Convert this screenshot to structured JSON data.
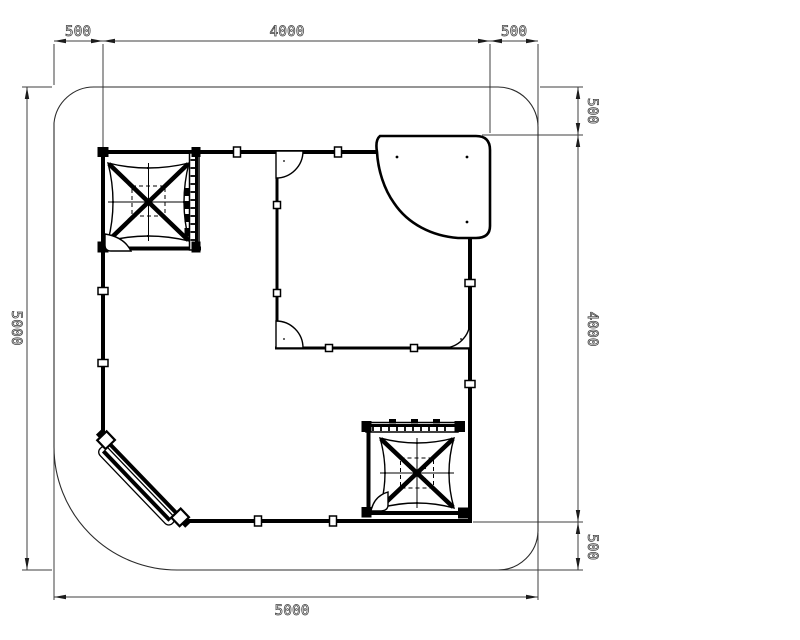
{
  "drawing": {
    "background": "#ffffff",
    "line_color": "#000000",
    "dimension_color": "#3f3f3f"
  },
  "dimensions": {
    "top": [
      {
        "label": "500"
      },
      {
        "label": "4000"
      },
      {
        "label": "500"
      }
    ],
    "right": [
      {
        "label": "500"
      },
      {
        "label": "4000"
      },
      {
        "label": "500"
      }
    ],
    "left": {
      "label": "5000"
    },
    "bottom": {
      "label": "5000"
    }
  }
}
